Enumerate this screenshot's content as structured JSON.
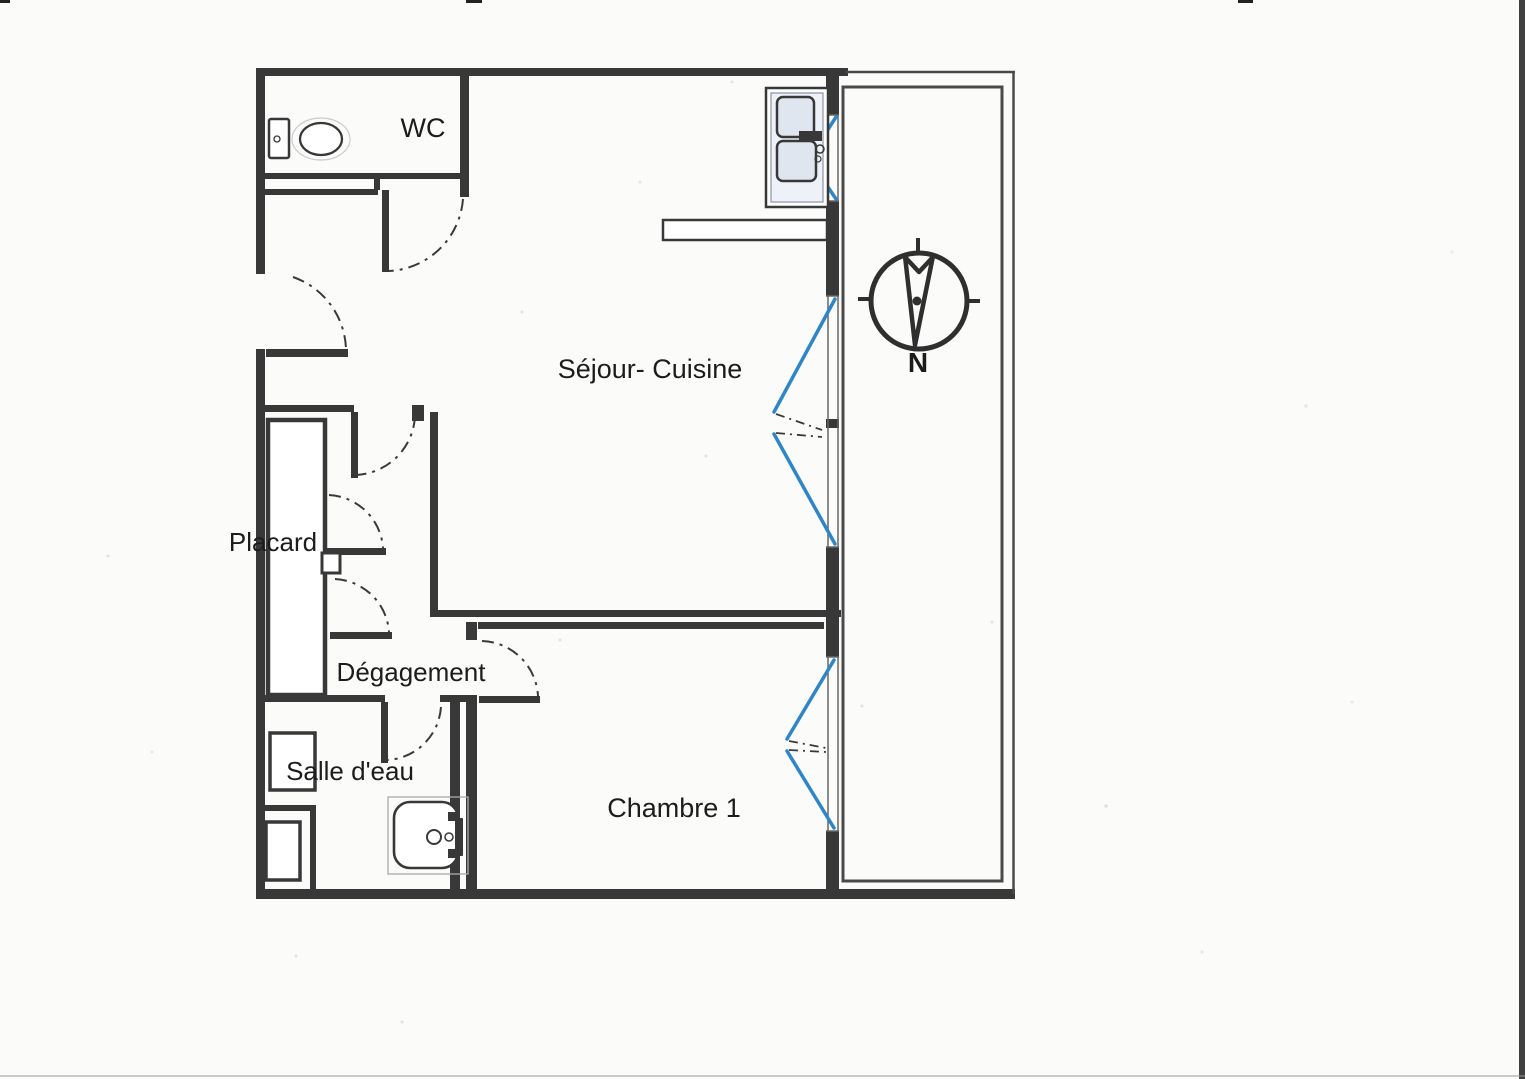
{
  "plan": {
    "rooms": [
      {
        "id": "wc",
        "label": "WC"
      },
      {
        "id": "sejour-cuisine",
        "label": "Séjour- Cuisine"
      },
      {
        "id": "placard",
        "label": "Placard"
      },
      {
        "id": "degagement",
        "label": "Dégagement"
      },
      {
        "id": "salle-deau",
        "label": "Salle d'eau"
      },
      {
        "id": "chambre-1",
        "label": "Chambre 1"
      }
    ],
    "compass": {
      "north_label": "N",
      "orientation": "north-down"
    },
    "colors": {
      "wall": "#383838",
      "window_blue": "#2e86c9",
      "fixture_fill": "#dfe6f0",
      "paper": "#fbfbfa"
    },
    "fixtures": [
      "toilet",
      "kitchen-sink",
      "shower"
    ],
    "features": [
      "balcony-strip-east",
      "entry-door",
      "three-blue-windows",
      "closet-doors"
    ]
  }
}
